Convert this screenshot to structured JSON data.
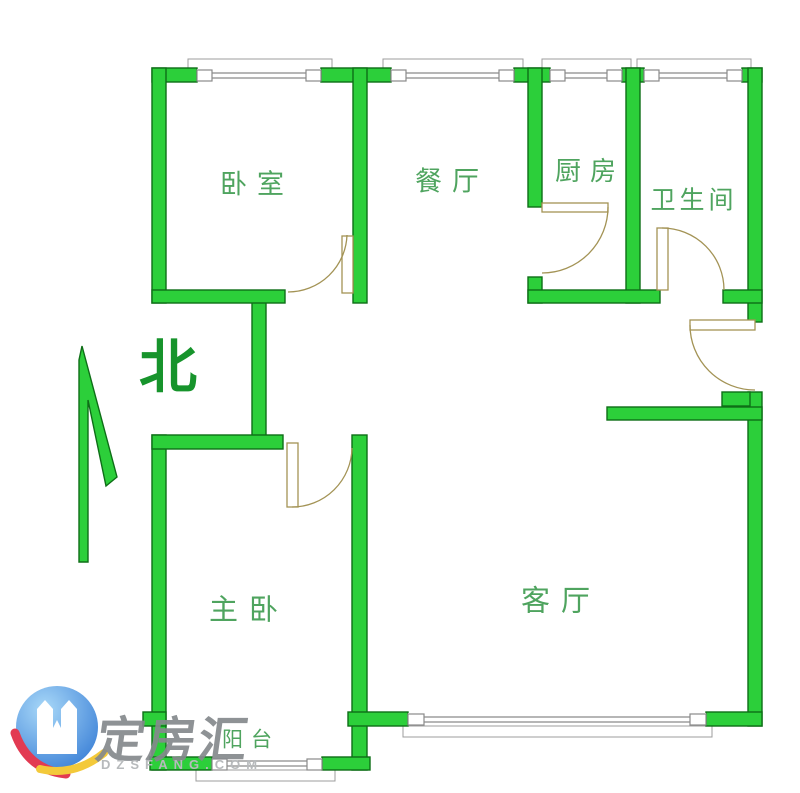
{
  "colors": {
    "bg": "#ffffff",
    "wall": "#2ccf3a",
    "wall-outline": "#0e6e17",
    "window-line": "#8a8a8a",
    "ledge": "#9c9c9c",
    "door": "#a39355",
    "label": "#4fa45f",
    "north": "#17942c",
    "brand-gray": "#85898d",
    "domain-gray": "#b7babc",
    "logo-blue-1": "#a8d8f8",
    "logo-blue-2": "#3a7fd6",
    "logo-red": "#e23a52",
    "logo-yellow": "#f3c93a"
  },
  "rooms": {
    "bedroom": "卧室",
    "dining": "餐厅",
    "kitchen": "厨房",
    "bathroom": "卫生间",
    "master": "主卧",
    "living": "客厅",
    "balcony": "阳台"
  },
  "compass": {
    "north": "北"
  },
  "watermark": {
    "brand": "定房汇",
    "domain": "DZSFANG.COM"
  }
}
